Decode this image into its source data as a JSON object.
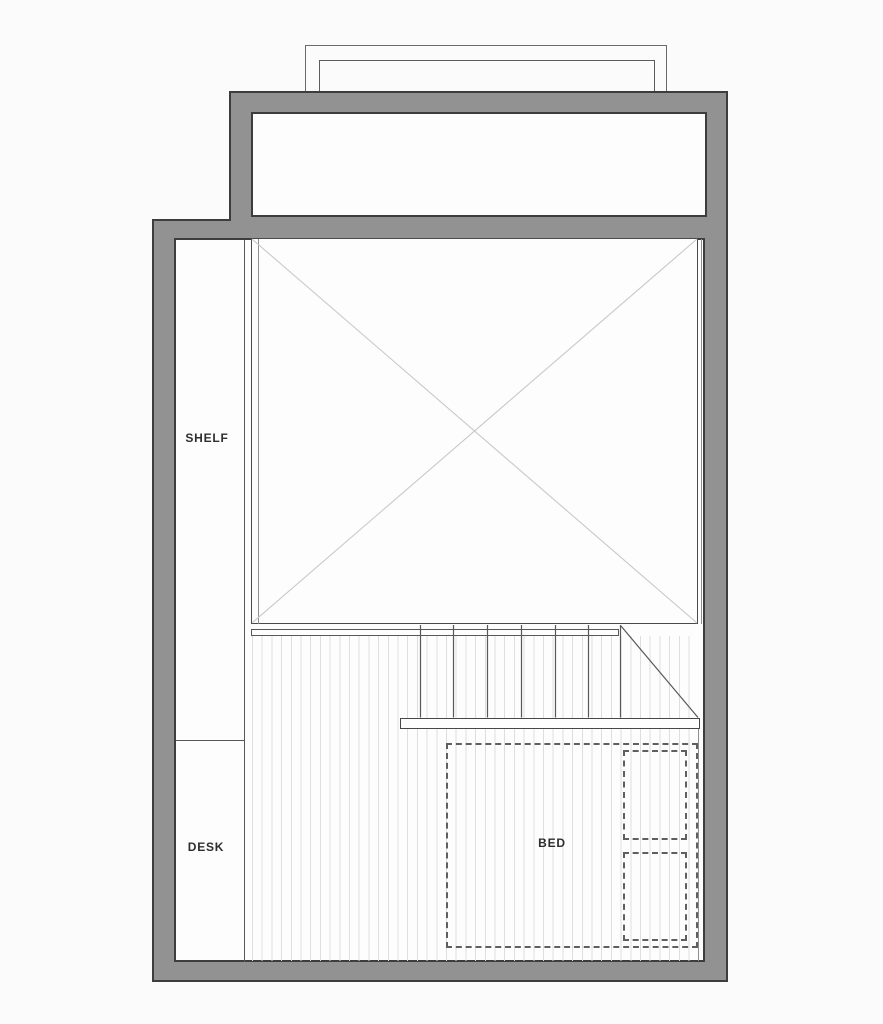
{
  "plan": {
    "labels": {
      "shelf": "SHELF",
      "desk": "DESK",
      "bed": "BED"
    },
    "colors": {
      "background": "#fbfbfb",
      "room_fill": "#fdfdfd",
      "wall_fill": "#929292",
      "wall_outline": "#3d3d3d",
      "line_dark": "#585858",
      "line_mid": "#8f8f8f",
      "line_light": "#c9c9c9",
      "hatch": "#dedede",
      "dashed": "#5f5f5f",
      "text": "#2e2e2e"
    }
  }
}
